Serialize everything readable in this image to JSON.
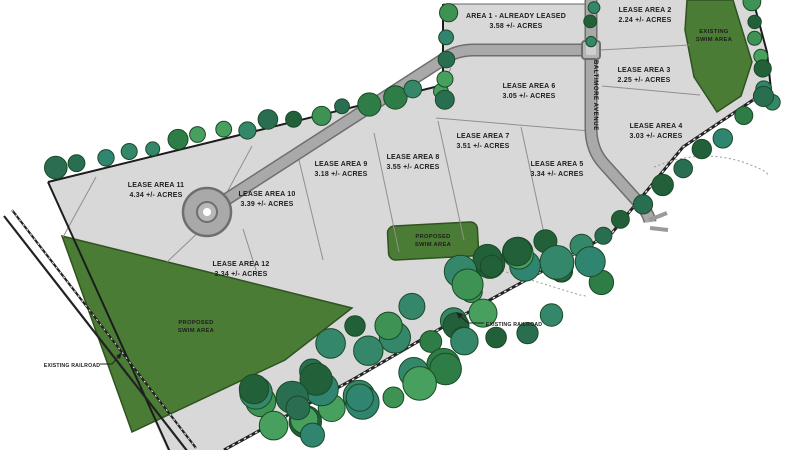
{
  "title": "Lease Areas Site Plan",
  "parcels": [
    {
      "name": "AREA 1 - ALREADY LEASED",
      "acres": "3.58 +/- ACRES"
    },
    {
      "name": "LEASE AREA 2",
      "acres": "2.24 +/- ACRES"
    },
    {
      "name": "LEASE AREA 3",
      "acres": "2.25 +/- ACRES"
    },
    {
      "name": "LEASE AREA 4",
      "acres": "3.03 +/- ACRES"
    },
    {
      "name": "LEASE AREA 5",
      "acres": "3.34 +/- ACRES"
    },
    {
      "name": "LEASE AREA 6",
      "acres": "3.05 +/- ACRES"
    },
    {
      "name": "LEASE AREA 7",
      "acres": "3.51 +/- ACRES"
    },
    {
      "name": "LEASE AREA 8",
      "acres": "3.55 +/- ACRES"
    },
    {
      "name": "LEASE AREA 9",
      "acres": "3.18 +/- ACRES"
    },
    {
      "name": "LEASE AREA 10",
      "acres": "3.39 +/- ACRES"
    },
    {
      "name": "LEASE AREA 11",
      "acres": "4.34 +/- ACRES"
    },
    {
      "name": "LEASE AREA 12",
      "acres": "3.34 +/- ACRES"
    }
  ],
  "swim": {
    "existing": {
      "l1": "EXISTING",
      "l2": "SWIM AREA"
    },
    "proposed_center": {
      "l1": "PROPOSED",
      "l2": "SWIM AREA"
    },
    "proposed_left": {
      "l1": "PROPOSED",
      "l2": "SWIM AREA"
    }
  },
  "railroad": {
    "left_label": "EXISTING RAILROAD",
    "center_label": "EXISTING RAILROAD"
  },
  "road": {
    "name": "BALTIMORE AVENUE"
  },
  "colors": {
    "parcel_fill": "#d8d8d8",
    "boundary": "#1c1c1c",
    "parcel_line": "#8f8f8f",
    "road_fill": "#a9a9a9",
    "road_edge": "#6e6e6e",
    "green_fill": "#4b7c35",
    "green_edge": "#2f5220",
    "rail": "#222222",
    "arc": "#999999",
    "trees": [
      "#2e7d46",
      "#3d9254",
      "#216038",
      "#35876b",
      "#2a6e52",
      "#47a05e",
      "#2f8570"
    ],
    "tree_edge": "#1b4a26"
  }
}
